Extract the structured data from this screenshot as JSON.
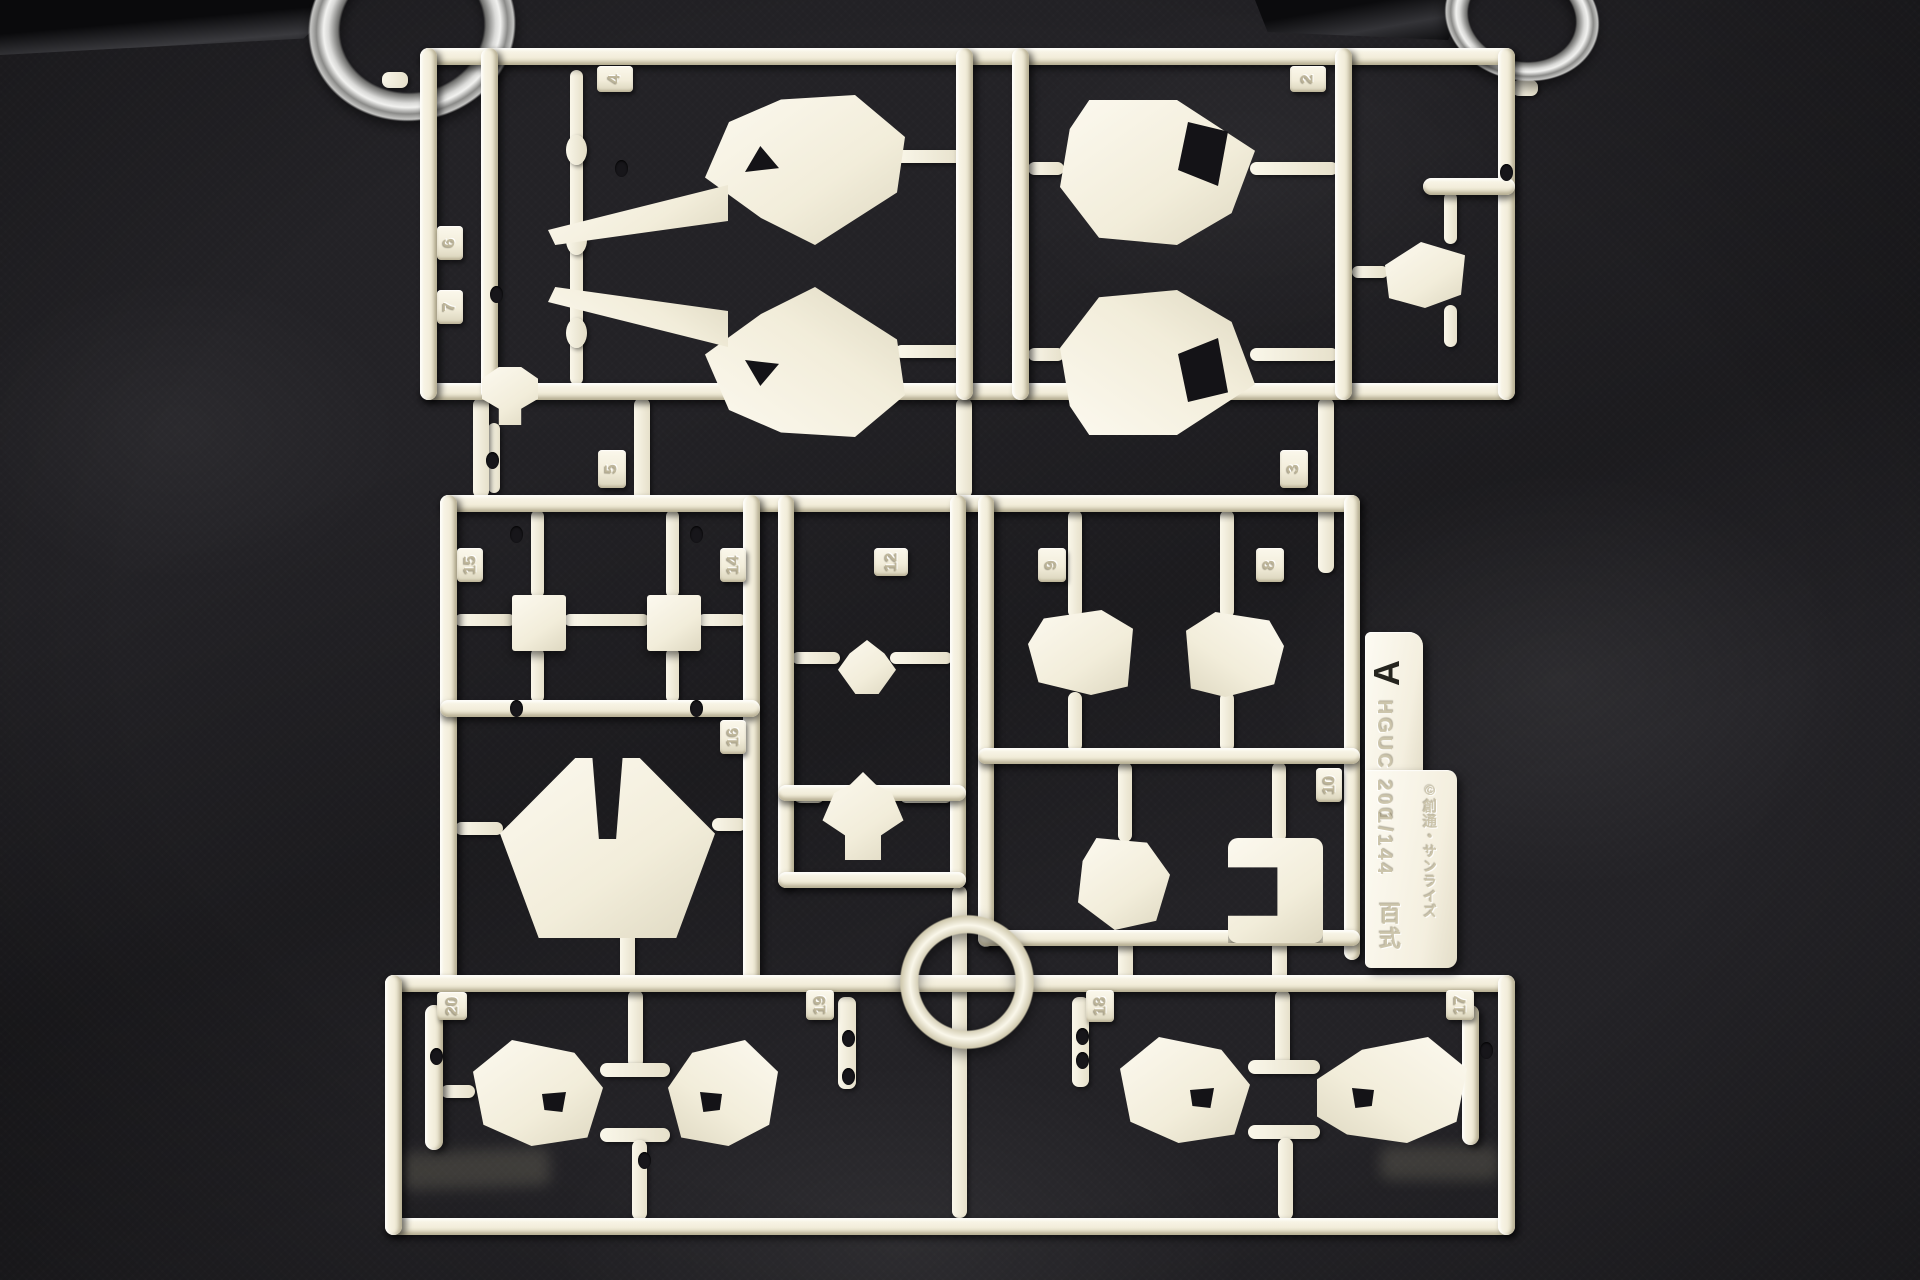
{
  "tag": {
    "runner_letter": "A",
    "kit_code": "HGUC 200",
    "scale": "1/144",
    "kit_name": "百式",
    "copyright": "©創通・サンライズ"
  },
  "gate_numbers": {
    "g4": "4",
    "g2": "2",
    "g6": "6",
    "g7": "7",
    "g5": "5",
    "g3": "3",
    "g15": "15",
    "g14": "14",
    "g12": "12",
    "g9": "9",
    "g8": "8",
    "g16": "16",
    "g10": "10",
    "g20": "20",
    "g19": "19",
    "g18": "18",
    "g17": "17"
  },
  "colors": {
    "plastic": "#f2edda",
    "plastic_shadow": "#d8d2ba",
    "background_fabric": "#232226",
    "metal_ring": "#c9c9c7",
    "mold_hole": "#141317"
  }
}
